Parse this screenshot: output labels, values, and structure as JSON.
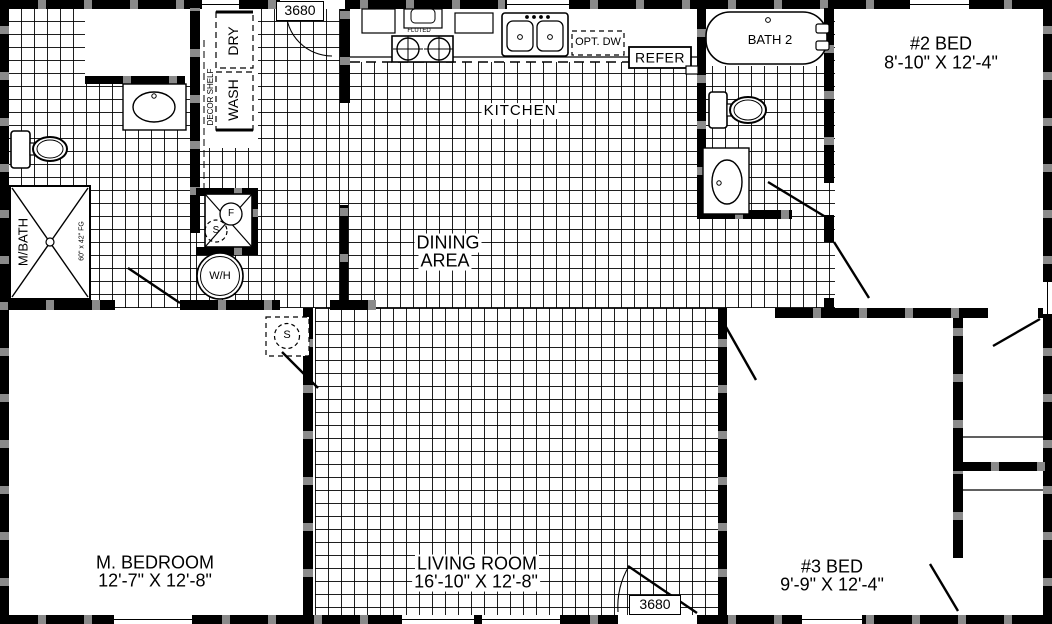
{
  "rooms": {
    "kitchen": {
      "label": "KITCHEN"
    },
    "dining": {
      "line1": "DINING",
      "line2": "AREA"
    },
    "living": {
      "label": "LIVING ROOM",
      "dims": "16'-10\" X 12'-8\""
    },
    "master_bedroom": {
      "label": "M. BEDROOM",
      "dims": "12'-7\" X 12'-8\""
    },
    "bed2": {
      "label": "#2 BED",
      "dims": "8'-10\" X 12'-4\""
    },
    "bed3": {
      "label": "#3 BED",
      "dims": "9'-9\" X 12'-4\""
    },
    "bath2": {
      "label": "BATH 2"
    },
    "master_bath": {
      "label": "M/BATH",
      "shower_size": "60\" x 42\" FG"
    }
  },
  "appliances": {
    "washer": "WASH",
    "dryer": "DRY",
    "decor_shelf": "DECOR SHELF",
    "water_heater": "W/H",
    "refrigerator": "REFER",
    "optional_dishwasher": "OPT. DW",
    "range": "FLUTED",
    "furnace": "F",
    "utility_sensor": "S",
    "bedroom_sensor": "S"
  },
  "door_tags": {
    "front": "3680",
    "rear": "3680"
  }
}
